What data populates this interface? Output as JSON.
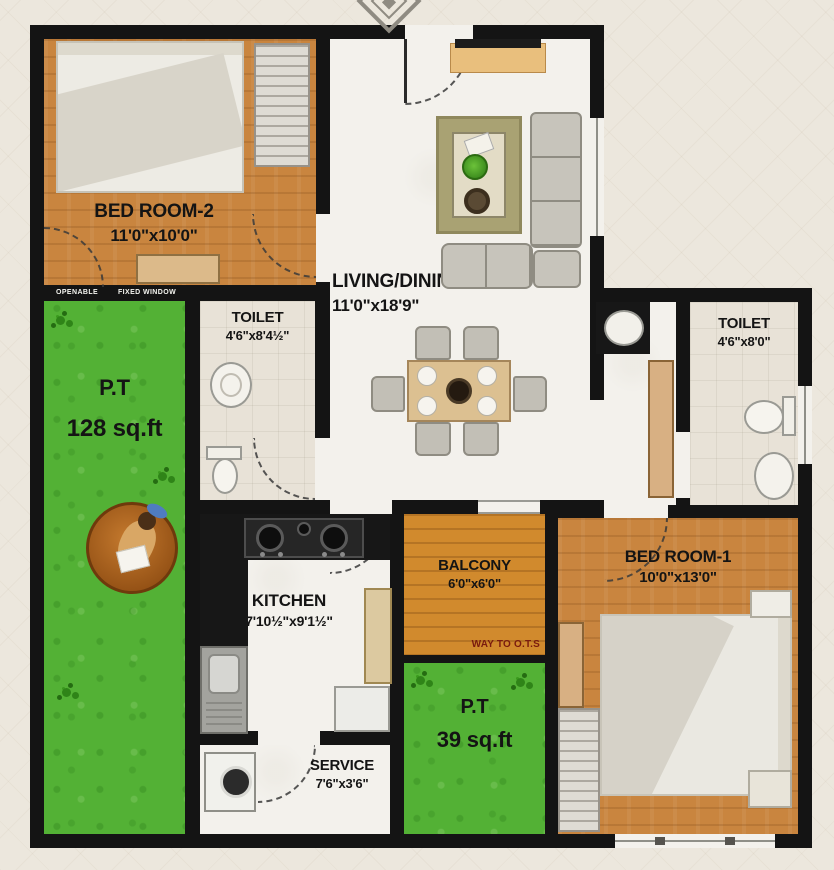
{
  "plan": {
    "type": "apartment-floor-plan",
    "rooms": [
      {
        "name": "BED ROOM-2",
        "dims": "11'0\"x10'0\""
      },
      {
        "name": "LIVING/DINING",
        "dims": "11'0\"x18'9\""
      },
      {
        "name": "TOILET",
        "dims": "4'6\"x8'4½\""
      },
      {
        "name": "TOILET",
        "dims": "4'6\"x8'0\""
      },
      {
        "name": "P.T",
        "dims": "128 sq.ft"
      },
      {
        "name": "KITCHEN",
        "dims": "7'10½\"x9'1½\""
      },
      {
        "name": "BALCONY",
        "dims": "6'0\"x6'0\""
      },
      {
        "name": "P.T",
        "dims": "39 sq.ft"
      },
      {
        "name": "BED ROOM-1",
        "dims": "10'0\"x13'0\""
      },
      {
        "name": "SERVICE",
        "dims": "7'6\"x3'6\""
      }
    ],
    "annotations": {
      "way_to_ots": "WAY TO O.T.S",
      "openable": "OPENABLE",
      "fixed_window": "FIXED WINDOW"
    }
  },
  "colors": {
    "wall": "#141414",
    "bedroom_wood": "#c9853f",
    "balcony_wood": "#d18a2d",
    "grass": "#53b135",
    "label_text": "#141414",
    "ots_text": "#7a1b0e",
    "sofa": "#c7c4bb",
    "dining_table": "#dcc091",
    "lounger": "#b06a24"
  }
}
